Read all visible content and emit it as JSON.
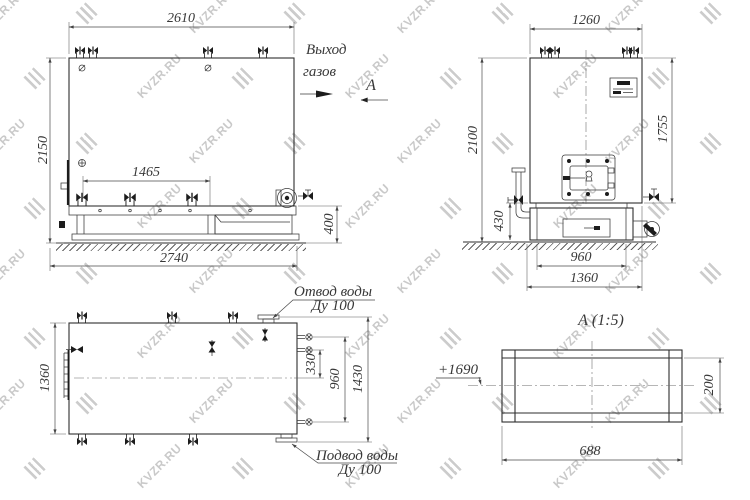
{
  "watermark": {
    "text": "KVZR.RU"
  },
  "front_view": {
    "dim_width_top": "2610",
    "dim_height_left": "2150",
    "dim_inner": "1465",
    "dim_width_bottom": "2740",
    "dim_height_right": "400",
    "gas_outlet_line1": "Выход",
    "gas_outlet_line2": "газов",
    "section_label": "А"
  },
  "side_view": {
    "dim_width_top": "1260",
    "dim_height_left": "2100",
    "dim_height_right": "1755",
    "dim_base_height": "430",
    "dim_base_inner": "960",
    "dim_base_outer": "1360"
  },
  "plan_view": {
    "dim_height_left": "1360",
    "dim_stub_offset": "330",
    "dim_stub_span": "960",
    "dim_flange_span": "1430",
    "outlet_label": "Отвод воды",
    "outlet_size": "Ду 100",
    "inlet_label": "Подвод воды",
    "inlet_size": "Ду 100"
  },
  "detail_view": {
    "title": "А  (1:5)",
    "elevation": "+1690",
    "dim_width": "688",
    "dim_height": "200"
  }
}
